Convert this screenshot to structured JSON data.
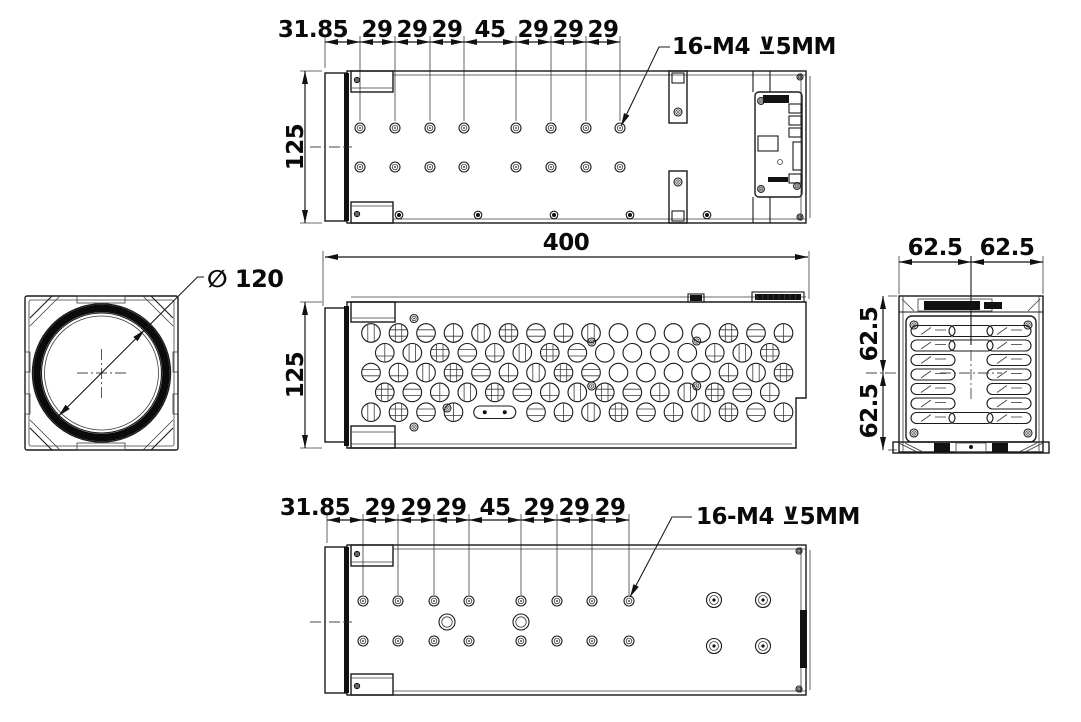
{
  "drawing_title": "lens module multi-view dimensional drawing",
  "views": {
    "top": {
      "chain": [
        "31.85",
        "29",
        "29",
        "29",
        "45",
        "29",
        "29",
        "29"
      ],
      "height": "125",
      "callout": "16-M4 ⊻5MM"
    },
    "front": {
      "diameter": "∅ 120"
    },
    "side": {
      "length": "400",
      "height": "125"
    },
    "rear": {
      "top_dims": [
        "62.5",
        "62.5"
      ],
      "side_dims": [
        "62.5",
        "62.5"
      ]
    },
    "bottom": {
      "chain": [
        "31.85",
        "29",
        "29",
        "29",
        "45",
        "29",
        "29",
        "29"
      ],
      "callout": "16-M4 ⊻5MM"
    }
  },
  "colors": {
    "line": "#1a1a1a",
    "background": "#ffffff"
  }
}
